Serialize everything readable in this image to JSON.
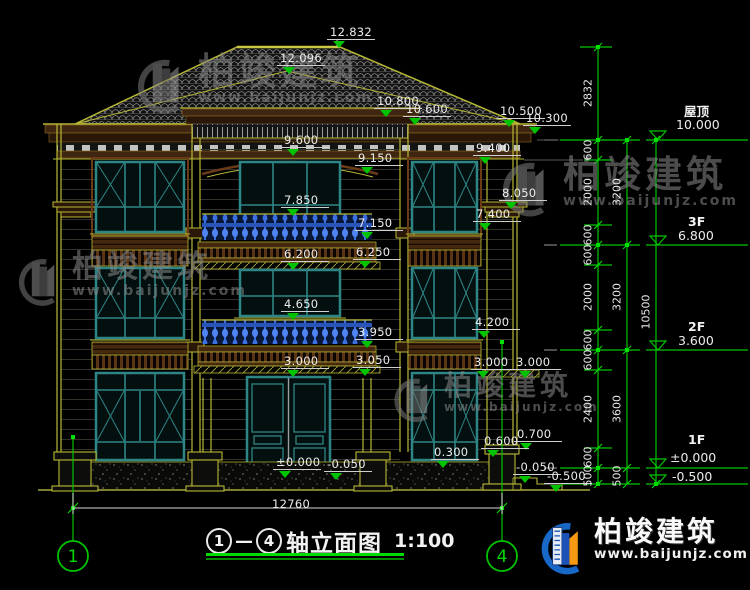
{
  "title_block": {
    "axis_from": "1",
    "axis_to": "4",
    "dash": "—",
    "title": "轴立面图",
    "scale": "1:100"
  },
  "axis_markers": [
    {
      "label": "1",
      "x": 73,
      "y": 557
    },
    {
      "label": "4",
      "x": 502,
      "y": 557
    }
  ],
  "overall_dim": {
    "text": "12760",
    "x": 272,
    "y": 498
  },
  "watermark": {
    "text": "柏竣建筑",
    "url": "www.baijunjz.com"
  },
  "logo": {
    "text": "柏竣建筑",
    "url": "www.baijunjz.com"
  },
  "elevation_markers": [
    {
      "name": "屋顶",
      "value": "10.000",
      "name_x": 684,
      "name_y": 101,
      "value_x": 676,
      "value_y": 117,
      "line_y": 140
    },
    {
      "name": "3F",
      "value": "6.800",
      "name_x": 688,
      "name_y": 214,
      "value_x": 678,
      "value_y": 228,
      "line_y": 245
    },
    {
      "name": "2F",
      "value": "3.600",
      "name_x": 688,
      "name_y": 319,
      "value_x": 678,
      "value_y": 333,
      "line_y": 350
    },
    {
      "name": "1F",
      "value": "±0.000",
      "name_x": 688,
      "name_y": 432,
      "value_x": 670,
      "value_y": 450,
      "line_y": 468
    },
    {
      "name": "",
      "value": "-0.500",
      "name_x": 0,
      "name_y": 0,
      "value_x": 672,
      "value_y": 469,
      "line_y": 484
    }
  ],
  "level_annotations": [
    {
      "text": "12.832",
      "x": 330,
      "y": 26
    },
    {
      "text": "12.096",
      "x": 280,
      "y": 52
    },
    {
      "text": "10.800",
      "x": 377,
      "y": 95
    },
    {
      "text": "10.600",
      "x": 406,
      "y": 103
    },
    {
      "text": "10.500",
      "x": 500,
      "y": 105
    },
    {
      "text": "10.300",
      "x": 526,
      "y": 112
    },
    {
      "text": "9.600",
      "x": 284,
      "y": 134
    },
    {
      "text": "9.400",
      "x": 476,
      "y": 142
    },
    {
      "text": "9.150",
      "x": 358,
      "y": 152
    },
    {
      "text": "8.050",
      "x": 502,
      "y": 187
    },
    {
      "text": "7.850",
      "x": 284,
      "y": 194
    },
    {
      "text": "7.400",
      "x": 476,
      "y": 208
    },
    {
      "text": "7.150",
      "x": 358,
      "y": 217
    },
    {
      "text": "6.250",
      "x": 356,
      "y": 246
    },
    {
      "text": "6.200",
      "x": 284,
      "y": 248
    },
    {
      "text": "4.650",
      "x": 284,
      "y": 298
    },
    {
      "text": "4.200",
      "x": 475,
      "y": 316
    },
    {
      "text": "3.950",
      "x": 358,
      "y": 326
    },
    {
      "text": "3.050",
      "x": 356,
      "y": 354
    },
    {
      "text": "3.000",
      "x": 284,
      "y": 355
    },
    {
      "text": "3.000",
      "x": 474,
      "y": 356
    },
    {
      "text": "3.000",
      "x": 516,
      "y": 356
    },
    {
      "text": "0.700",
      "x": 517,
      "y": 428
    },
    {
      "text": "0.600",
      "x": 484,
      "y": 435
    },
    {
      "text": "0.300",
      "x": 434,
      "y": 446
    },
    {
      "text": "±0.000",
      "x": 276,
      "y": 456
    },
    {
      "text": "-0.050",
      "x": 327,
      "y": 458
    },
    {
      "text": "-0.050",
      "x": 516,
      "y": 461
    },
    {
      "text": "-0.500",
      "x": 547,
      "y": 470
    }
  ],
  "ladder_labels": [
    {
      "text": "2832",
      "x": 588,
      "y": 93
    },
    {
      "text": "600",
      "x": 588,
      "y": 150
    },
    {
      "text": "2000",
      "x": 588,
      "y": 192
    },
    {
      "text": "600",
      "x": 588,
      "y": 235
    },
    {
      "text": "600",
      "x": 588,
      "y": 255
    },
    {
      "text": "2000",
      "x": 588,
      "y": 297
    },
    {
      "text": "600",
      "x": 588,
      "y": 340
    },
    {
      "text": "600",
      "x": 588,
      "y": 360
    },
    {
      "text": "2400",
      "x": 588,
      "y": 409
    },
    {
      "text": "600",
      "x": 588,
      "y": 457
    },
    {
      "text": "500",
      "x": 588,
      "y": 476
    },
    {
      "text": "3200",
      "x": 617,
      "y": 192
    },
    {
      "text": "3200",
      "x": 617,
      "y": 297
    },
    {
      "text": "3600",
      "x": 617,
      "y": 409
    },
    {
      "text": "500",
      "x": 617,
      "y": 476
    },
    {
      "text": "10500",
      "x": 646,
      "y": 312
    }
  ]
}
